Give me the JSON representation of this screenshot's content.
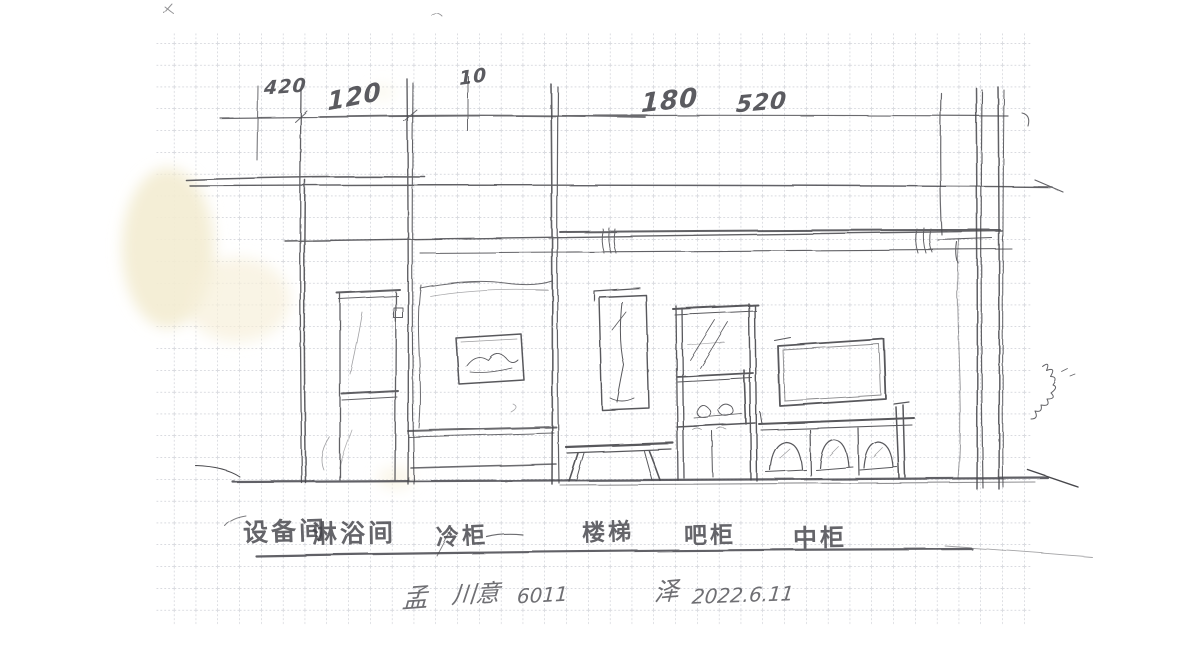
{
  "annotations": {
    "dimensions": [
      "420",
      "120",
      "10",
      "180",
      "520"
    ]
  },
  "labels": {
    "room_equipment": "设备间",
    "room_shower": "淋浴间",
    "fridge": "冷柜",
    "stairs": "楼梯",
    "bar_cabinet": "吧柜",
    "middle_cabinet": "中柜"
  },
  "signature": {
    "lead": "孟",
    "name": "川意",
    "number": "6011",
    "mark": "泽",
    "date": "2022.6.11"
  },
  "colors": {
    "pencil": "#47474c",
    "grid": "#9fa2af",
    "paper": "#ffffff",
    "stain": "#f3ecd2"
  }
}
